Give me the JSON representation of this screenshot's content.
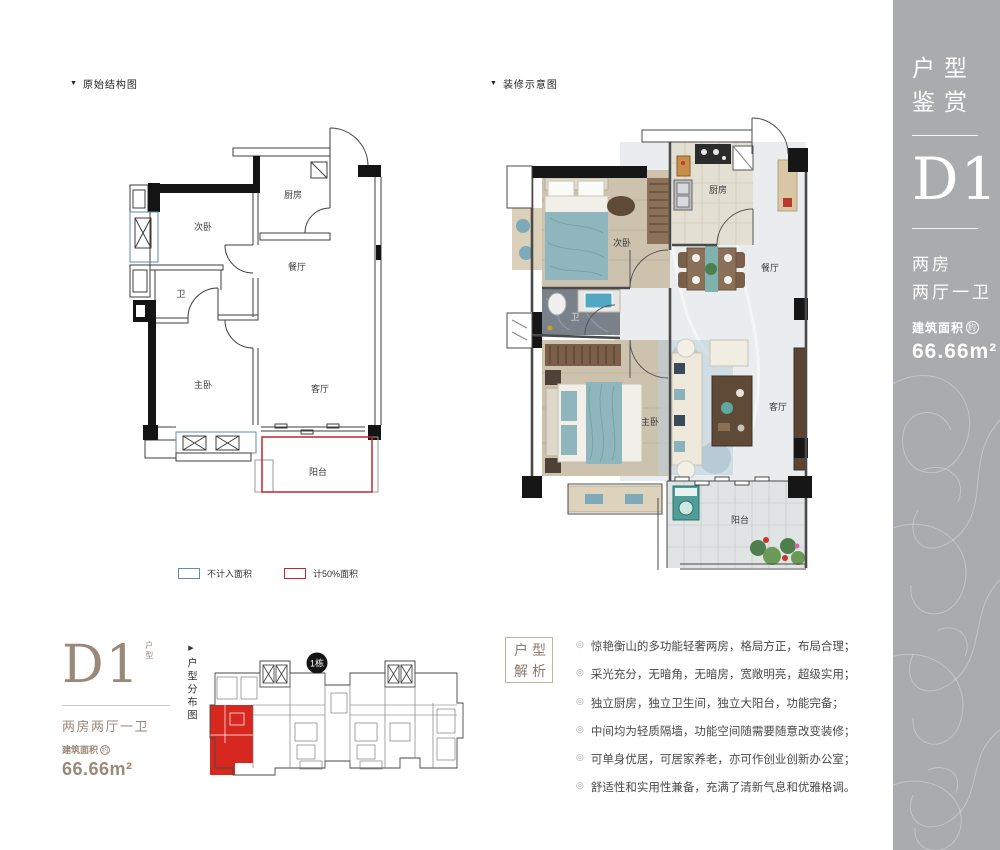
{
  "plans": {
    "original": {
      "marker": "▼",
      "title": "原始结构图"
    },
    "decorated": {
      "marker": "▼",
      "title": "装修示意图"
    }
  },
  "rooms": {
    "bedroom2": "次卧",
    "kitchen": "厨房",
    "dining": "餐厅",
    "bath": "卫",
    "master": "主卧",
    "living": "客厅",
    "balcony": "阳台"
  },
  "legend": {
    "not_counted": {
      "label": "不计入面积",
      "color": "#5b8fb0"
    },
    "half_counted": {
      "label": "计50%面积",
      "color": "#c1272d"
    }
  },
  "sidebar": {
    "bg": "#a9acae",
    "heading_line1": "户型",
    "heading_line2": "鉴赏",
    "unit_code": "D1",
    "unit_suffix": "户型",
    "spec_line1": "两房",
    "spec_line2": "两厅一卫",
    "area_label": "建筑面积",
    "area_circle": "约",
    "area_value": "66.66m²"
  },
  "unit_card": {
    "accent": "#9a8878",
    "code": "D1",
    "suffix": "户型",
    "spec": "两房两厅一卫",
    "area_label": "建筑面积",
    "area_circle": "约",
    "area_value": "66.66m²"
  },
  "distribution": {
    "marker": "▶",
    "label": "户型分布图",
    "badge": "1栋",
    "highlight_color": "#d6281f"
  },
  "analysis": {
    "box_line1": "户型",
    "box_line2": "解析",
    "bullet_marker": "◎",
    "bullets": [
      "惊艳衡山的多功能轻奢两房，格局方正，布局合理；",
      "采光充分，无暗角，无暗房，宽敞明亮，超级实用；",
      "独立厨房，独立卫生间，独立大阳台，功能完备；",
      "中间均为轻质隔墙，功能空间随需要随意改变装修；",
      "可单身优居，可居家养老，亦可作创业创新办公室；",
      "舒适性和实用性兼备，充满了清新气息和优雅格调。"
    ]
  }
}
